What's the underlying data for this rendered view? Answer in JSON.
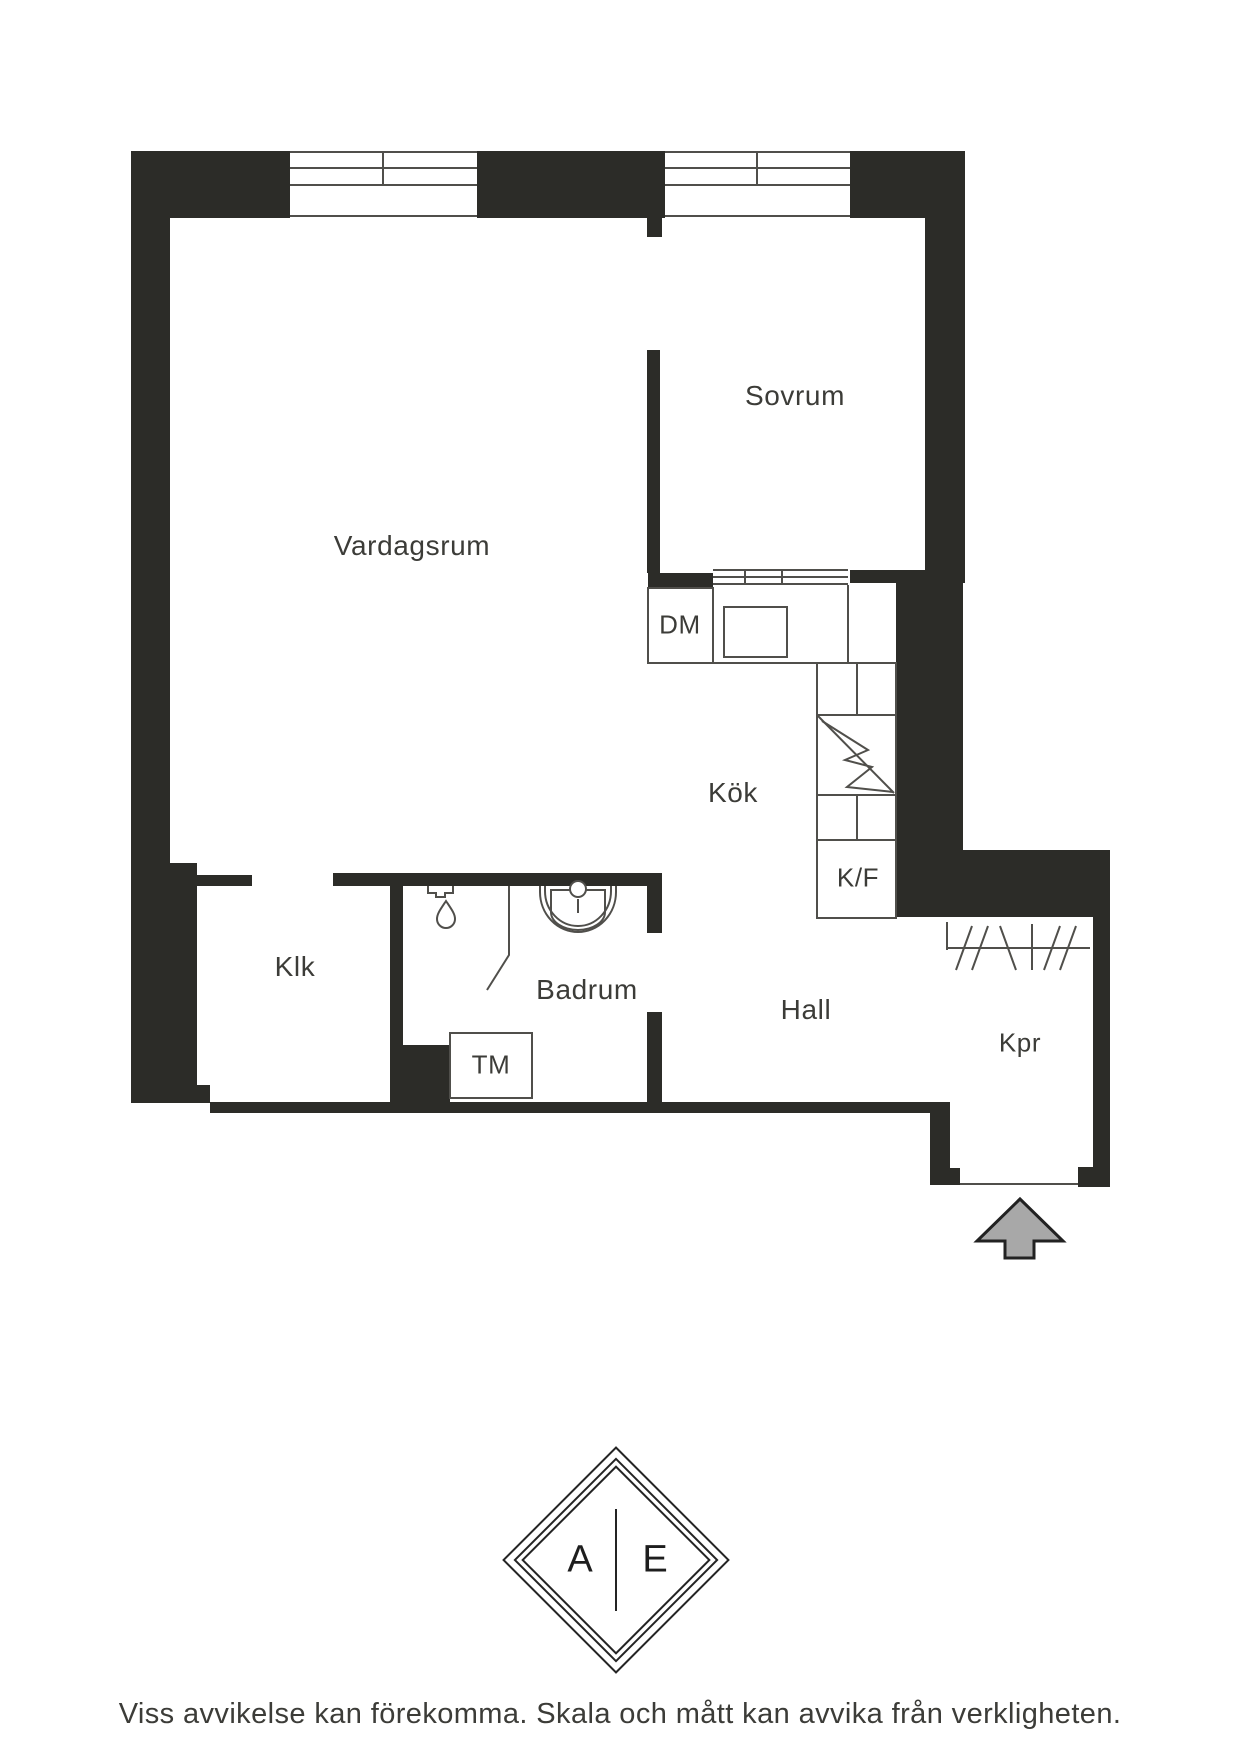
{
  "floor_plan": {
    "rooms": {
      "vardagsrum": {
        "label": "Vardagsrum"
      },
      "sovrum": {
        "label": "Sovrum"
      },
      "kok": {
        "label": "Kök"
      },
      "klk": {
        "label": "Klk"
      },
      "badrum": {
        "label": "Badrum"
      },
      "hall": {
        "label": "Hall"
      },
      "kpr": {
        "label": "Kpr"
      }
    },
    "appliances": {
      "dishwasher": {
        "label": "DM"
      },
      "fridge_freezer": {
        "label": "K/F"
      },
      "washing_machine": {
        "label": "TM"
      }
    },
    "symbols": {
      "entrance_arrow": "entrance-arrow",
      "shower": "shower-fixture-icon",
      "shower_screen": "shower-screen",
      "bathroom_sink": "bathroom-sink-icon",
      "kitchen_sink": "kitchen-sink",
      "electrical": "lightning-bolt-icon",
      "wardrobe_rail": "wardrobe-hatching",
      "windows": "window-symbol"
    }
  },
  "logo": {
    "letter_left": "A",
    "letter_right": "E"
  },
  "footer": {
    "disclaimer": "Viss avvikelse kan förekomma. Skala och mått kan avvika från verkligheten."
  },
  "colors": {
    "wall": "#2c2c28",
    "line": "#504f4b",
    "text": "#3c3c38",
    "arrow_fill": "#a8a8a8",
    "background": "#ffffff"
  }
}
